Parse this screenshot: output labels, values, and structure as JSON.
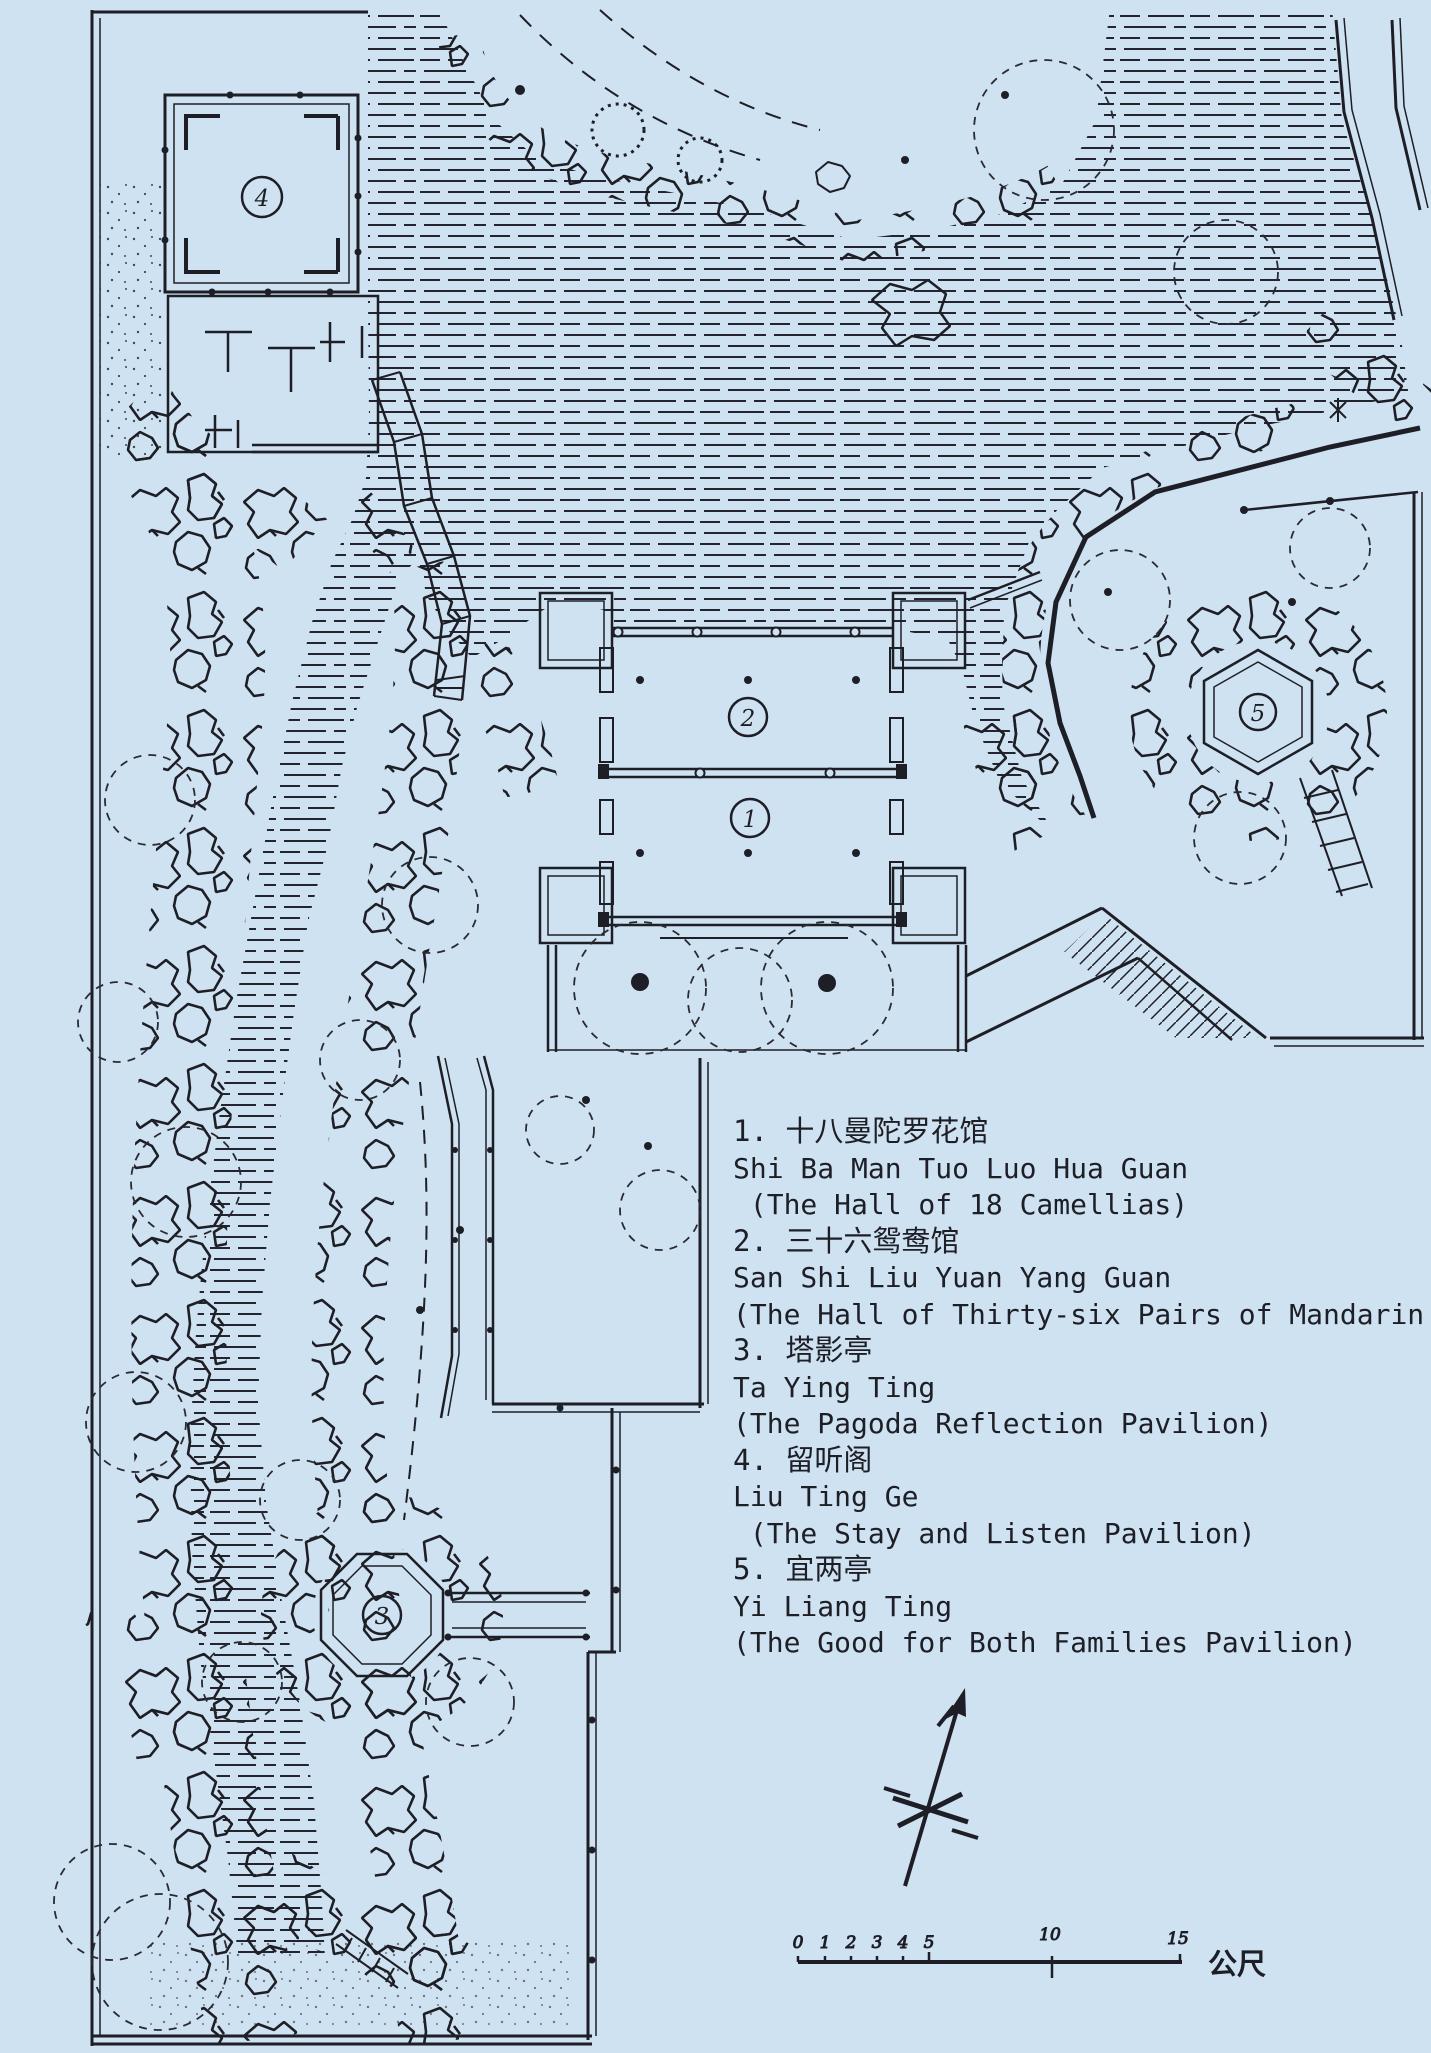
{
  "palette": {
    "paper": "#cfe2f1",
    "ink": "#1e1e26",
    "water_line": "#242430"
  },
  "map": {
    "type": "hand-drawn garden plan",
    "markers": [
      "1",
      "2",
      "3",
      "4",
      "5"
    ]
  },
  "legend": {
    "lines": [
      "1. 十八曼陀罗花馆",
      "Shi Ba Man Tuo Luo Hua Guan",
      " (The Hall of 18 Camellias)",
      "2. 三十六鸳鸯馆",
      "San Shi Liu Yuan Yang Guan",
      "(The Hall of Thirty-six Pairs of Mandarin Ducks)",
      "3. 塔影亭",
      "Ta Ying Ting",
      "(The Pagoda Reflection Pavilion)",
      "4. 留听阁",
      "Liu Ting Ge",
      " (The Stay and Listen Pavilion)",
      "5. 宜两亭",
      "Yi Liang Ting",
      "(The Good for Both Families Pavilion)"
    ]
  },
  "scalebar": {
    "labels": [
      "0",
      "1",
      "2",
      "3",
      "4",
      "5",
      "10",
      "15"
    ],
    "unit": "公尺"
  }
}
